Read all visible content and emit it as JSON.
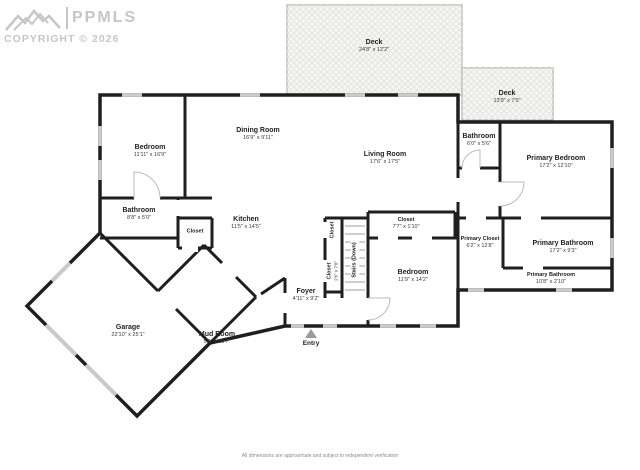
{
  "watermark": {
    "brand": "PPMLS",
    "copyright": "COPYRIGHT © 2026",
    "logo": "mountains-icon"
  },
  "entry": {
    "label": "Entry"
  },
  "disclaimer": "All dimensions are approximate and subject to independent verification",
  "rooms": [
    {
      "name": "Deck",
      "dims": "24'8\" x 12'2\""
    },
    {
      "name": "Deck",
      "dims": "13'9\" x 7'0\""
    },
    {
      "name": "Bedroom",
      "dims": "11'11\" x 16'9\""
    },
    {
      "name": "Dining Room",
      "dims": "16'9\" x 9'11\""
    },
    {
      "name": "Living Room",
      "dims": "17'6\" x 17'5\""
    },
    {
      "name": "Bathroom",
      "dims": "6'0\" x 5'6\""
    },
    {
      "name": "Primary Bedroom",
      "dims": "17'2\" x 12'10\""
    },
    {
      "name": "Bathroom",
      "dims": "8'8\" x 5'0\""
    },
    {
      "name": "Closet",
      "dims": ""
    },
    {
      "name": "Kitchen",
      "dims": "11'5\" x 14'5\""
    },
    {
      "name": "Closet",
      "dims": ""
    },
    {
      "name": "Closet",
      "dims": "2'6\" x 7'0\""
    },
    {
      "name": "Stairs (Down)",
      "dims": ""
    },
    {
      "name": "Closet",
      "dims": "7'7\" x 1'10\""
    },
    {
      "name": "Bedroom",
      "dims": "11'9\" x 14'2\""
    },
    {
      "name": "Primary Closet",
      "dims": "6'2\" x 12'8\""
    },
    {
      "name": "Primary Bathroom",
      "dims": "17'2\" x 9'3\""
    },
    {
      "name": "Primary Bathroom",
      "dims": "10'8\" x 2'10\""
    },
    {
      "name": "Foyer",
      "dims": "4'11\" x 9'2\""
    },
    {
      "name": "Garage",
      "dims": "22'10\" x 25'1\""
    },
    {
      "name": "Mud Room",
      "dims": "5'9\" x 10'7\""
    }
  ],
  "colors": {
    "wall": "#1f1f1f",
    "window": "#cccccc",
    "deck_fill": "#f5f5f3",
    "watermark": "#c6c6c6"
  }
}
